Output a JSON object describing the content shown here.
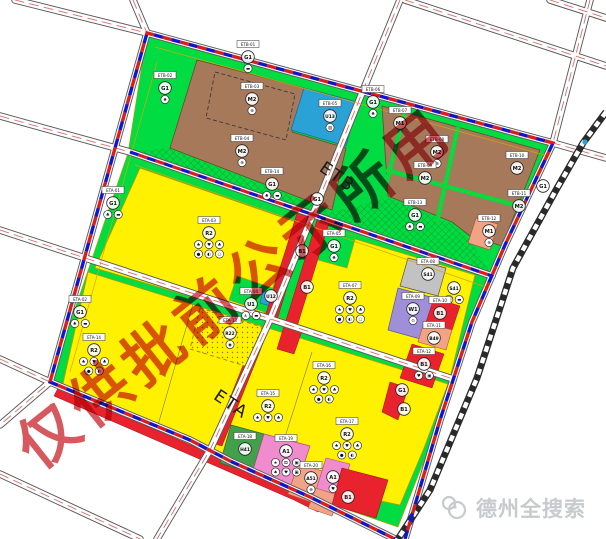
{
  "map": {
    "watermark": "仅供批前公示所用",
    "zone_labels": [
      {
        "id": "ETB",
        "text": "ETB"
      },
      {
        "id": "ETA",
        "text": "ETA"
      }
    ],
    "logo": {
      "text": "德州全搜索",
      "icon": "bird-logo-icon"
    },
    "palette": {
      "residential_yellow": "#FFF100",
      "green_space": "#00DC41",
      "industrial_brown": "#A6795B",
      "utility_blue": "#2BA2D6",
      "commercial_red": "#E8232E",
      "public_pink": "#F08CCE",
      "logistics_purple": "#9E8FD8",
      "transport_gray": "#C2C2C2",
      "medical_salmon": "#F2A385",
      "special_darkgreen": "#43A04A",
      "boundary_red": "#D81E1E",
      "boundary_blue": "#1515C8",
      "watermark_red": "#CC2A33",
      "railway_black": "#2A2A2A"
    },
    "parcel_labels": [
      {
        "box": "ETB-01",
        "code": "G1",
        "x": 248,
        "y": 57,
        "icons": [
          "▬"
        ]
      },
      {
        "box": "ETB-02",
        "code": "G1",
        "x": 165,
        "y": 88,
        "icons": [
          "♣"
        ]
      },
      {
        "box": "ETB-03",
        "code": "M2",
        "x": 252,
        "y": 99,
        "icons": [
          "⊛"
        ]
      },
      {
        "box": "ETB-04",
        "code": "M2",
        "x": 242,
        "y": 151,
        "icons": [
          "⊛"
        ]
      },
      {
        "box": "ETB-05",
        "code": "U13",
        "x": 330,
        "y": 116,
        "icons": [
          "▨"
        ]
      },
      {
        "box": "ETB-06",
        "code": "G1",
        "x": 373,
        "y": 102,
        "icons": [
          "♣"
        ]
      },
      {
        "box": "ETB-07",
        "code": "M1",
        "x": 400,
        "y": 123,
        "icons": []
      },
      {
        "box": "ETB-08",
        "code": "M2",
        "x": 437,
        "y": 152,
        "icons": [
          "⊛"
        ]
      },
      {
        "box": "ETB-09",
        "code": "M2",
        "x": 425,
        "y": 178,
        "icons": []
      },
      {
        "box": "ETB-10",
        "code": "M2",
        "x": 517,
        "y": 168,
        "icons": []
      },
      {
        "box": "ETB-11",
        "code": "M2",
        "x": 519,
        "y": 206,
        "icons": []
      },
      {
        "box": "ETB-12",
        "code": "M1",
        "x": 489,
        "y": 231,
        "icons": [
          "⊛"
        ]
      },
      {
        "box": "ETB-13",
        "code": "G1",
        "x": 415,
        "y": 215,
        "icons": [
          "♣",
          "▬"
        ]
      },
      {
        "box": "ETB-14",
        "code": "G1",
        "x": 272,
        "y": 184,
        "icons": [
          "♣",
          "▬"
        ]
      },
      {
        "code": "G1",
        "x": 543,
        "y": 186,
        "icons": []
      },
      {
        "box": "ETA-01",
        "code": "G1",
        "x": 113,
        "y": 203,
        "icons": [
          "♣",
          "▬"
        ]
      },
      {
        "box": "ETA-02",
        "code": "G1",
        "x": 80,
        "y": 312,
        "icons": [
          "♣",
          "▬"
        ]
      },
      {
        "box": "ETA-03",
        "code": "R2",
        "x": 209,
        "y": 233,
        "icons": [
          "♠",
          "♥",
          "♣",
          "●",
          "◐",
          "○"
        ]
      },
      {
        "box": "ETA-04",
        "code": "U1",
        "x": 251,
        "y": 304,
        "icons": [
          "♿",
          "▬"
        ]
      },
      {
        "code": "U12",
        "x": 271,
        "y": 296,
        "icons": []
      },
      {
        "box": "ETA-05",
        "code": "G1",
        "x": 334,
        "y": 246,
        "icons": [
          "♣"
        ]
      },
      {
        "code": "B1",
        "x": 302,
        "y": 251,
        "icons": []
      },
      {
        "code": "B1",
        "x": 307,
        "y": 287,
        "icons": []
      },
      {
        "code": "G1",
        "x": 317,
        "y": 199,
        "icons": []
      },
      {
        "box": "ETA-07",
        "code": "R2",
        "x": 350,
        "y": 298,
        "icons": [
          "♠",
          "♥",
          "♣",
          "●",
          "◐",
          "○"
        ]
      },
      {
        "box": "ETA-08",
        "code": "S41",
        "x": 428,
        "y": 274,
        "icons": []
      },
      {
        "code": "S41",
        "x": 454,
        "y": 288,
        "icons": [
          "●",
          "▬"
        ]
      },
      {
        "box": "ETA-09",
        "code": "W1",
        "x": 413,
        "y": 309,
        "icons": [
          "⊙"
        ]
      },
      {
        "box": "ETA-10",
        "code": "B1",
        "x": 440,
        "y": 313,
        "icons": []
      },
      {
        "box": "ETA-11",
        "code": "B49",
        "x": 434,
        "y": 338,
        "icons": []
      },
      {
        "box": "ETA-12",
        "code": "B1",
        "x": 424,
        "y": 364,
        "icons": [
          "♥",
          "▣"
        ]
      },
      {
        "box": "ETA-13",
        "code": "R22",
        "x": 230,
        "y": 333,
        "icons": [
          "◉"
        ]
      },
      {
        "box": "ETA-14",
        "code": "R2",
        "x": 94,
        "y": 350,
        "icons": [
          "♠",
          "♥",
          "♣",
          "●",
          "◐"
        ]
      },
      {
        "box": "ETA-15",
        "code": "R2",
        "x": 268,
        "y": 406,
        "icons": [
          "♠",
          "♥",
          "♣"
        ]
      },
      {
        "box": "ETA-16",
        "code": "R2",
        "x": 324,
        "y": 378,
        "icons": [
          "♠",
          "♥",
          "♣",
          "●",
          "◐"
        ]
      },
      {
        "box": "ETA-17",
        "code": "R2",
        "x": 347,
        "y": 434,
        "icons": [
          "♠",
          "♥",
          "♣",
          "●",
          "◐"
        ]
      },
      {
        "box": "ETA-18",
        "code": "H41",
        "x": 245,
        "y": 449,
        "icons": []
      },
      {
        "box": "ETA-19",
        "code": "A1",
        "x": 286,
        "y": 451,
        "icons": [
          "★",
          "⚄",
          "▣",
          "♠",
          "♥",
          "▣"
        ]
      },
      {
        "box": "ETA-20",
        "code": "A51",
        "x": 311,
        "y": 478,
        "icons": [
          "⊕"
        ]
      },
      {
        "code": "A1",
        "x": 333,
        "y": 477,
        "icons": [
          "♥"
        ]
      },
      {
        "code": "B1",
        "x": 348,
        "y": 497,
        "icons": []
      },
      {
        "code": "G1",
        "x": 402,
        "y": 390,
        "icons": []
      },
      {
        "code": "B1",
        "x": 404,
        "y": 409,
        "icons": []
      }
    ]
  }
}
